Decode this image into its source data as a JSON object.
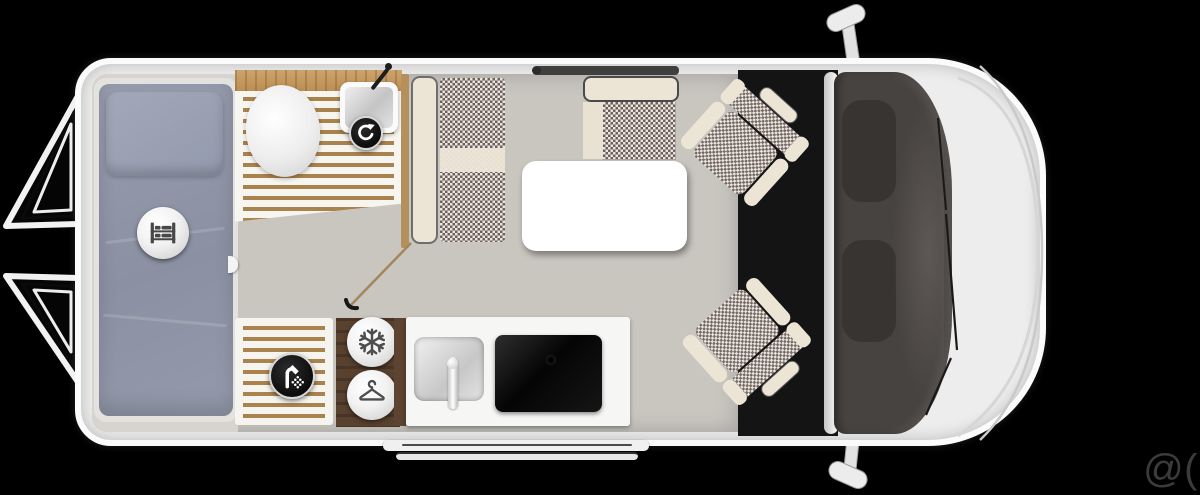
{
  "watermark": {
    "text": "@( Bazos.cz"
  },
  "floorplan": {
    "subject": "campervan top-view floor plan",
    "icons": {
      "bed": "bunk-bed",
      "toilet_swivel": "rotate-arrow",
      "shower": "shower-head",
      "fridge": "snowflake",
      "wardrobe": "clothes-hanger"
    }
  },
  "colors": {
    "background": "#000000",
    "body": "#ededed",
    "floor": "#c9c6c0",
    "bedroom_floor": "#d7d4d0",
    "bedding": "#8f95a7",
    "upholstery_check": "#6e615c",
    "upholstery_cream": "#ece5d6",
    "wood_light": "#b5905c",
    "wood_dark": "#59412f",
    "cab_floor": "#141414",
    "windshield": "#474341",
    "watermark": "#3b3b3b"
  }
}
